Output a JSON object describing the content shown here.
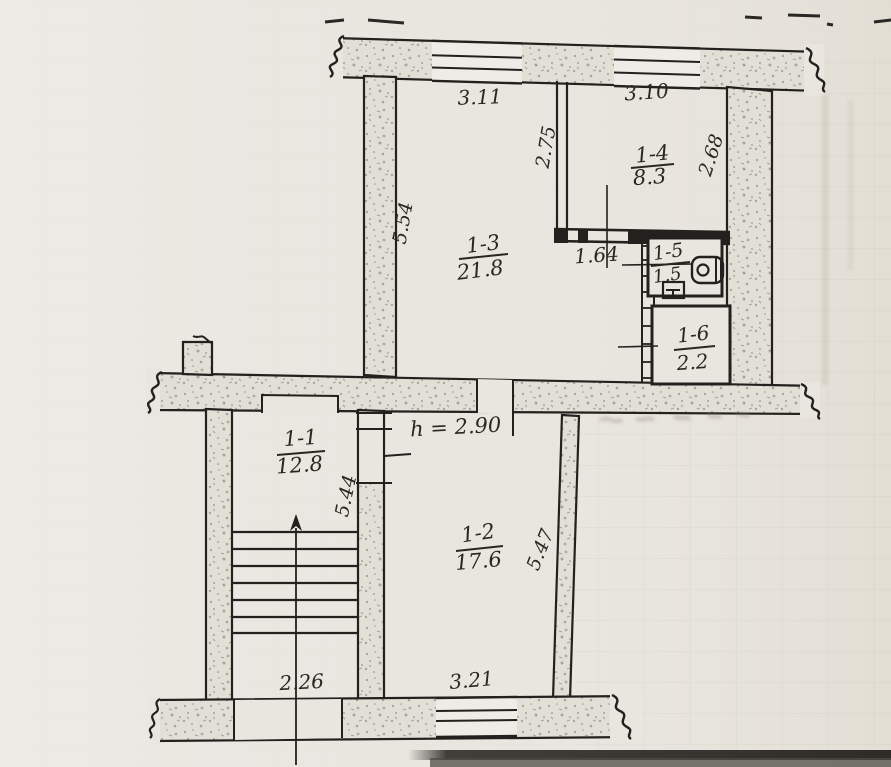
{
  "plan": {
    "rooms": [
      {
        "number": "1-1",
        "area": "12.8"
      },
      {
        "number": "1-2",
        "area": "17.6"
      },
      {
        "number": "1-3",
        "area": "21.8"
      },
      {
        "number": "1-4",
        "area": "8.3"
      },
      {
        "number": "1-5",
        "area": "1.5"
      },
      {
        "number": "1-6",
        "area": "2.2"
      }
    ],
    "dimensions": {
      "top_span_left": "3.11",
      "top_span_right": "3.10",
      "partition_height": "2.75",
      "right_span": "2.68",
      "left_span": "5.54",
      "hall_width": "1.64",
      "stair_span": "5.44",
      "room2_span": "5.47",
      "ceiling_height": "h = 2.90",
      "bottom_left_span": "2.26",
      "bottom_mid_span": "3.21"
    },
    "colors": {
      "paper": "#e9e6e0",
      "ink": "#23211d",
      "wall_fill": "#e2dfd7"
    }
  }
}
